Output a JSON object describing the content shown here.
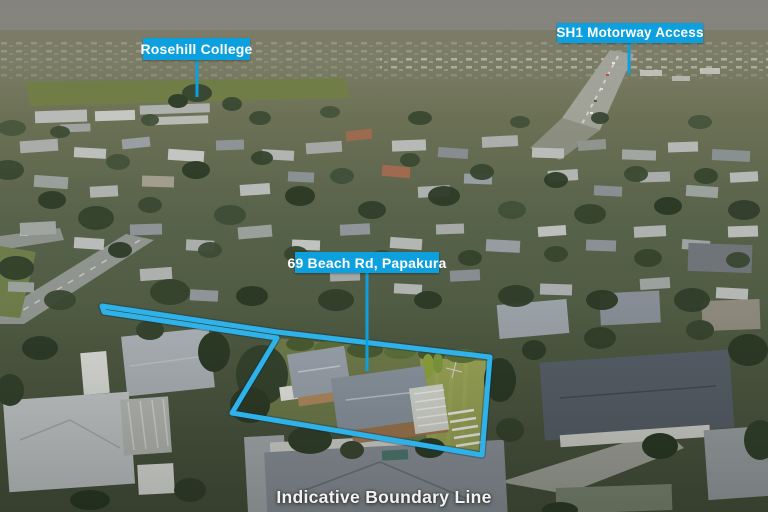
{
  "annotations": {
    "college_label": "Rosehill College",
    "motorway_label": "SH1 Motorway Access",
    "address_label": "69 Beach Rd, Papakura",
    "caption": "Indicative Boundary Line"
  },
  "colors": {
    "label_bg": "#0da0de",
    "label_text": "#ffffff",
    "boundary_line": "#2eb2e9",
    "caption_text": "#f2f2f0"
  }
}
